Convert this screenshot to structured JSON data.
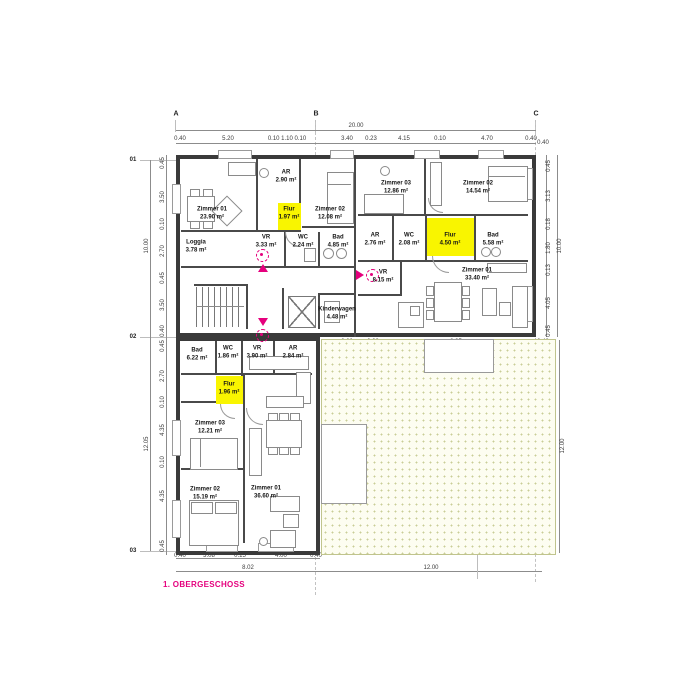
{
  "sheet": {
    "title": "1. OBERGESCHOSS"
  },
  "grid": {
    "cols": [
      "A",
      "B",
      "C"
    ],
    "rows": [
      "01",
      "02",
      "03"
    ]
  },
  "colors": {
    "highlight": "#f9f500",
    "accent": "#e5007d",
    "wall": "#3a3a3a",
    "garden_dot": "#c9cd96"
  },
  "rooms": [
    {
      "name": "Zimmer 01",
      "area": "23.90 m²"
    },
    {
      "name": "Loggia",
      "area": "3.78 m²"
    },
    {
      "name": "AR",
      "area": "2.90 m²"
    },
    {
      "name": "Flur",
      "area": "1.97 m²"
    },
    {
      "name": "VR",
      "area": "3.33 m²"
    },
    {
      "name": "WC",
      "area": "2.24 m²"
    },
    {
      "name": "Zimmer 02",
      "area": "12.08 m²"
    },
    {
      "name": "Bad",
      "area": "4.85 m²"
    },
    {
      "name": "Zimmer 03",
      "area": "12.86 m²"
    },
    {
      "name": "Zimmer 02",
      "area": "14.54 m²"
    },
    {
      "name": "AR",
      "area": "2.76 m²"
    },
    {
      "name": "WC",
      "area": "2.08 m²"
    },
    {
      "name": "Flur",
      "area": "4.50 m²"
    },
    {
      "name": "Bad",
      "area": "5.58 m²"
    },
    {
      "name": "VR",
      "area": "8.15 m²"
    },
    {
      "name": "Zimmer 01",
      "area": "33.40 m²"
    },
    {
      "name": "Kinderwagen",
      "area": "4.48 m²"
    },
    {
      "name": "Bad",
      "area": "6.22 m²"
    },
    {
      "name": "WC",
      "area": "1.86 m²"
    },
    {
      "name": "VR",
      "area": "3.90 m²"
    },
    {
      "name": "AR",
      "area": "2.84 m²"
    },
    {
      "name": "Flur",
      "area": "1.96 m²"
    },
    {
      "name": "Zimmer 03",
      "area": "12.21 m²"
    },
    {
      "name": "Zimmer 02",
      "area": "15.19 m²"
    },
    {
      "name": "Zimmer 01",
      "area": "36.60 m²"
    }
  ],
  "dims": {
    "top": {
      "total": "20.00",
      "chain": [
        "0.40",
        "5.20",
        "0.10 1.10 0.10",
        "3.40",
        "0.23",
        "4.15",
        "0.10",
        "4.70",
        "0.40"
      ]
    },
    "left": {
      "upper_total": "10.00",
      "lower_total": "12.05",
      "chain_upper": [
        "0.45",
        "3.50",
        "0.10",
        "2.70",
        "0.45",
        "3.50",
        "0.40"
      ],
      "chain_lower": [
        "0.45",
        "2.70",
        "0.10",
        "4.35",
        "0.10",
        "4.35",
        "0.45"
      ]
    },
    "right": {
      "total": "10.00",
      "corner": "0.40",
      "chain": [
        "0.45",
        "3.13",
        "0.18",
        "1.80",
        "0.13",
        "4.05",
        "0.45"
      ],
      "garden_side": "12.00"
    },
    "bottom": {
      "chain": [
        "0.40",
        "3.08",
        "0.15",
        "4.00",
        "0.40"
      ],
      "total_left": "8.02",
      "total_right": "12.00"
    },
    "garden": {
      "chain": [
        "2.60",
        "0.23",
        "8.95",
        "0.48"
      ],
      "vertical": "10.05"
    }
  }
}
